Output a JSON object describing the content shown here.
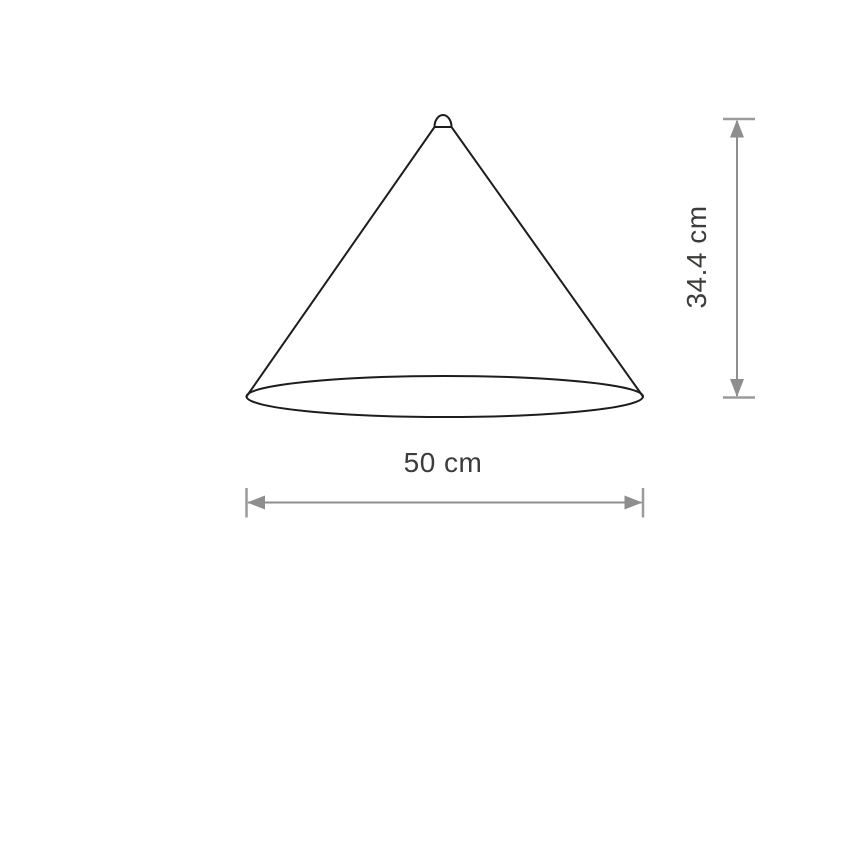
{
  "diagram": {
    "dimensions": {
      "width": {
        "value": 50,
        "unit": "cm",
        "label": "50 cm"
      },
      "height": {
        "value": 34.4,
        "unit": "cm",
        "label": "34.4 cm"
      }
    },
    "colors": {
      "outline": "#1d1d1b",
      "dimension_lines": "#8e8e8e",
      "ticks": "#9b9b9b",
      "text": "#3c3c3b",
      "background": "#ffffff"
    }
  }
}
